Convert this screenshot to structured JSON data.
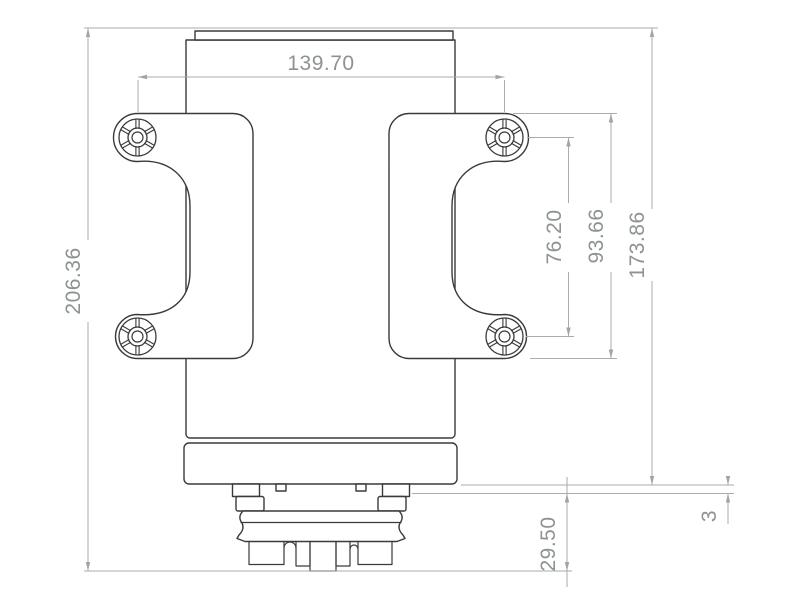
{
  "page": {
    "background": "#ffffff"
  },
  "colors": {
    "part_outline": "#3a3a3a",
    "dimension_lines": "#a8acac",
    "dimension_text": "#8d9293"
  },
  "dimensions": {
    "hole_spacing_horizontal": "139.70",
    "overall_height": "206.36",
    "hole_spacing_vertical": "76.20",
    "mounting_plate_height": "93.66",
    "height_to_mounting_face": "173.86",
    "connector_depth": "29.50",
    "boss_standoff": "3"
  }
}
